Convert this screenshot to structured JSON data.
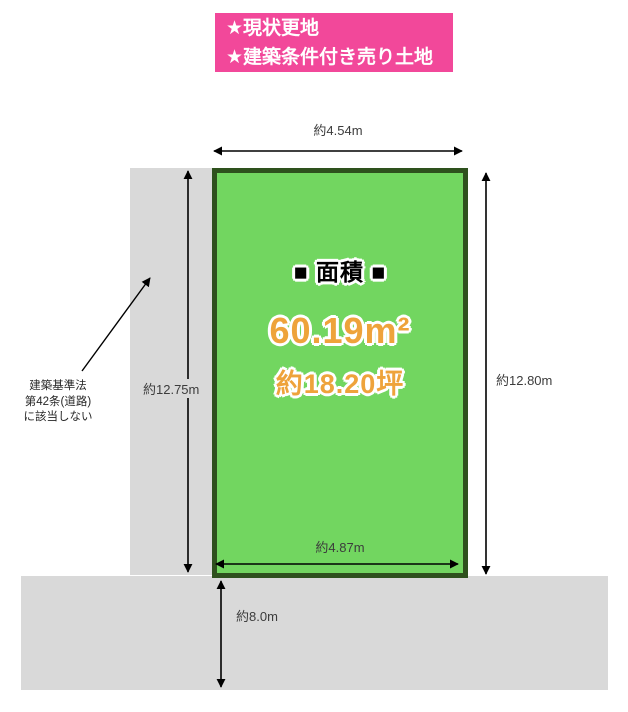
{
  "banner": {
    "lines": [
      "★現状更地",
      "★建築条件付き売り土地"
    ]
  },
  "plot": {
    "heading": "■ 面積 ■",
    "area": "60.19m²",
    "tsubo": "約18.20坪"
  },
  "dimensions": {
    "top_width": "約4.54m",
    "left_height": "約12.75m",
    "right_height": "約12.80m",
    "bottom_width": "約4.87m",
    "road_width": "約8.0m"
  },
  "note": {
    "lines": [
      "建築基準法",
      "第42条(道路)",
      "に該当しない"
    ]
  },
  "colors": {
    "banner_bg": "#F2489A",
    "banner_text": "#FFFFFF",
    "plot_fill": "#72D660",
    "plot_border": "#2E511D",
    "area_text": "#EEA33B",
    "heading_text": "#000000",
    "road_fill": "#D9D9D9",
    "dimension_text": "#3C3C3C"
  }
}
